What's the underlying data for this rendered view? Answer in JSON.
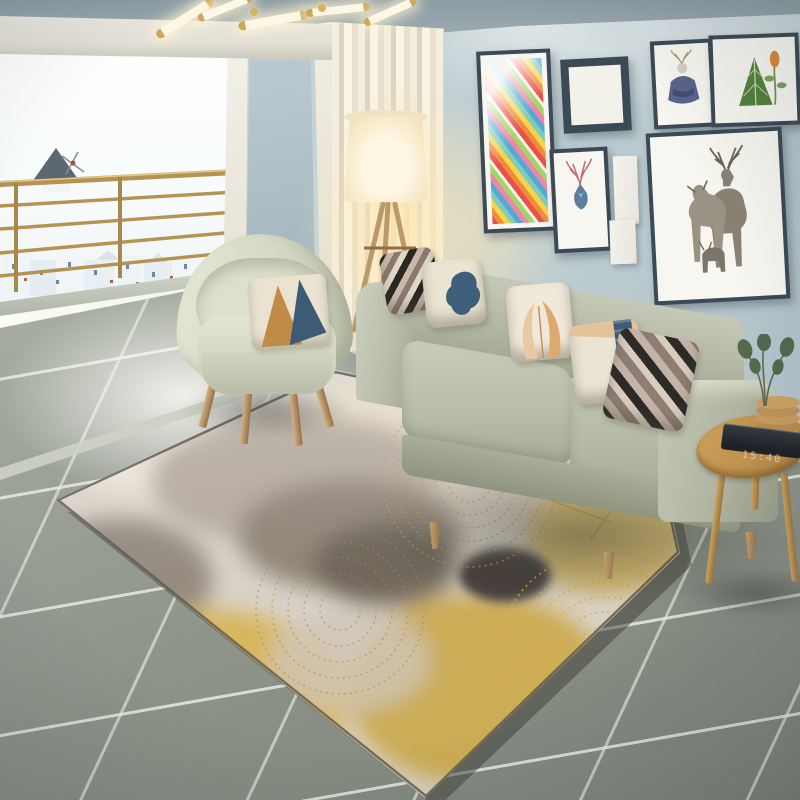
{
  "scene": {
    "title": "Bright Scandinavian living room with abstract grey-gold area rug",
    "clock_display": "15:40",
    "objects": {
      "ceiling_lamp": "brass tube sputnik chandelier",
      "balcony": "open balcony with brass railing over a white hillside village",
      "windmill": "grey windmill silhouette on horizon",
      "curtain": "cream pleated curtain",
      "floor_lamp": "lit tripod floor lamp with drum shade",
      "gallery_wall": [
        "tall colorful geometric stripe print",
        "blank white canvas in frame",
        "watercolor deer head print",
        "small blank canvas pair",
        "deer in blue sweater print",
        "botanical fern print",
        "deer family print"
      ],
      "sofa": "greige three-seat fabric sofa",
      "sofa_pillows": [
        "dark stripe",
        "cream with navy patch",
        "cream with apricot tulips",
        "cream with navy band",
        "mauve stripe"
      ],
      "armchair": "pale sage barrel chair with geometric cushion",
      "rug": "abstract rug with grey ink wash, gold dotted swirls and gold mesh lines",
      "side_table": "round wooden tripod side table",
      "table_items": [
        "black digital clock",
        "stacked wooden coasters",
        "green leaf sprigs"
      ],
      "floor": "large grey stone tiles"
    },
    "palette": {
      "wall": "#c3d2d6",
      "ceiling": "#93a2a9",
      "curtain": "#f0e9d8",
      "sofa": "#b4b8a6",
      "armchair": "#dadec9",
      "rug_base": "#d8d2c8",
      "rug_gold": "#d3a93c",
      "rug_grey": "#8b8278",
      "tile": "#8f958a",
      "wood": "#c29a62",
      "frame": "#3c4a56",
      "railing": "#b69352"
    }
  }
}
